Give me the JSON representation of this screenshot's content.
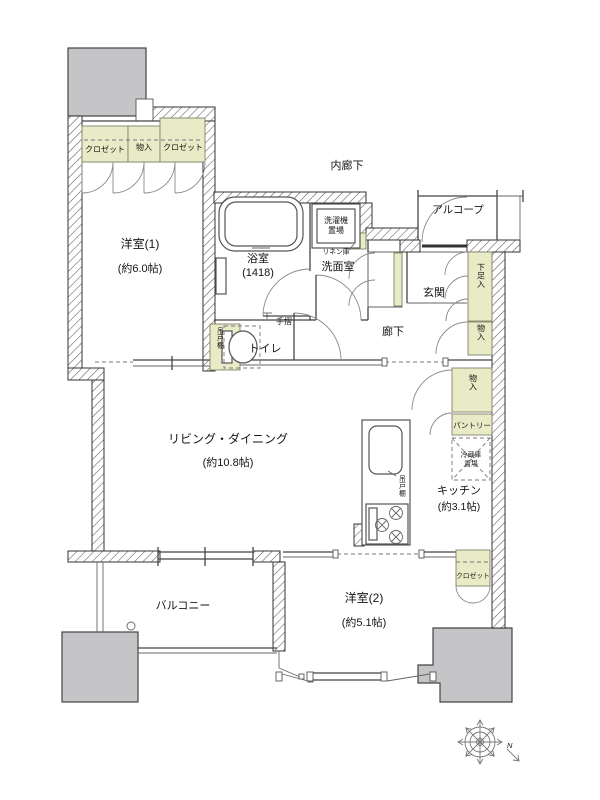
{
  "colors": {
    "closet_fill": "#e8ebc6",
    "pillar_fill": "#c5c5c7",
    "wall_line": "#333333",
    "text": "#151515"
  },
  "rooms": {
    "bedroom1": {
      "name": "洋室(1)",
      "size": "(約6.0帖)"
    },
    "bedroom1_closets": [
      "クロゼット",
      "物入",
      "クロゼット"
    ],
    "bath": {
      "name": "浴室",
      "size": "(1418)"
    },
    "laundry": {
      "line1": "洗濯機",
      "line2": "置場"
    },
    "washroom": "洗面室",
    "linen": "リネン庫",
    "toilet": "トイレ",
    "handrail": "手摺",
    "toilet_cabinet": "吊戸棚",
    "inner_corridor": "内廊下",
    "alcove": "アルコープ",
    "entrance": "玄関",
    "shoe_cabinet": "下足入",
    "entry_storage": "物入",
    "corridor": "廊下",
    "hall_storage": "物入",
    "pantry": "パントリー",
    "fridge": {
      "line1": "冷蔵庫",
      "line2": "置場"
    },
    "kitchen": {
      "name": "キッチン",
      "size": "(約3.1帖)"
    },
    "hanging_cupboard": "吊戸棚",
    "living": {
      "name": "リビング・ダイニング",
      "size": "(約10.8帖)"
    },
    "bedroom2": {
      "name": "洋室(2)",
      "size": "(約5.1帖)"
    },
    "bedroom2_closet": "クロゼット",
    "balcony": "バルコニー"
  },
  "compass": {
    "north": "N"
  }
}
